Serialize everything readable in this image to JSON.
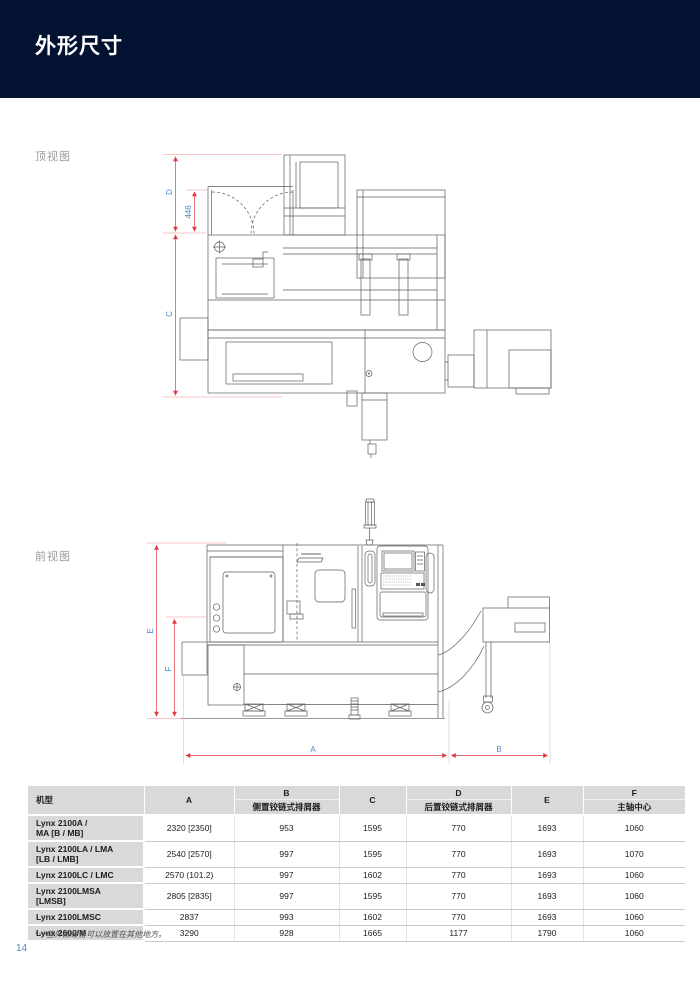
{
  "page": {
    "title": "外形尺寸",
    "number": "14",
    "footnote": "*一些外围设备可以放置在其他地方。"
  },
  "top_view": {
    "label": "顶视图",
    "dim_d": "D",
    "dim_c": "C",
    "dim_inner": "446"
  },
  "front_view": {
    "label": "前视图",
    "dim_e": "E",
    "dim_f": "F",
    "dim_a": "A",
    "dim_b": "B"
  },
  "table": {
    "col_model": "机型",
    "col_a": "A",
    "col_b": "B",
    "col_b_sub": "侧置铰链式排屑器",
    "col_c": "C",
    "col_d": "D",
    "col_d_sub": "后置铰链式排屑器",
    "col_e": "E",
    "col_f": "F",
    "col_f_sub": "主轴中心",
    "rows": [
      {
        "model": "Lynx 2100A /\nMA [B / MB]",
        "a": "2320 [2350]",
        "b": "953",
        "c": "1595",
        "d": "770",
        "e": "1693",
        "f": "1060"
      },
      {
        "model": "Lynx 2100LA / LMA\n[LB / LMB]",
        "a": "2540 [2570]",
        "b": "997",
        "c": "1595",
        "d": "770",
        "e": "1693",
        "f": "1070"
      },
      {
        "model": "Lynx 2100LC / LMC",
        "a": "2570 (101.2)",
        "b": "997",
        "c": "1602",
        "d": "770",
        "e": "1693",
        "f": "1060"
      },
      {
        "model": "Lynx 2100LMSA\n[LMSB]",
        "a": "2805 [2835]",
        "b": "997",
        "c": "1595",
        "d": "770",
        "e": "1693",
        "f": "1060"
      },
      {
        "model": "Lynx 2100LMSC",
        "a": "2837",
        "b": "993",
        "c": "1602",
        "d": "770",
        "e": "1693",
        "f": "1060"
      },
      {
        "model": "Lynx 2600/M",
        "a": "3290",
        "b": "928",
        "c": "1665",
        "d": "1177",
        "e": "1790",
        "f": "1060"
      }
    ]
  },
  "colors": {
    "banner_bg": "#021230",
    "dimension_line": "#e23a3f",
    "dimension_label": "#4e86c0",
    "table_header_bg": "#d9d9d9",
    "drawing_stroke": "#5f5f5f"
  }
}
